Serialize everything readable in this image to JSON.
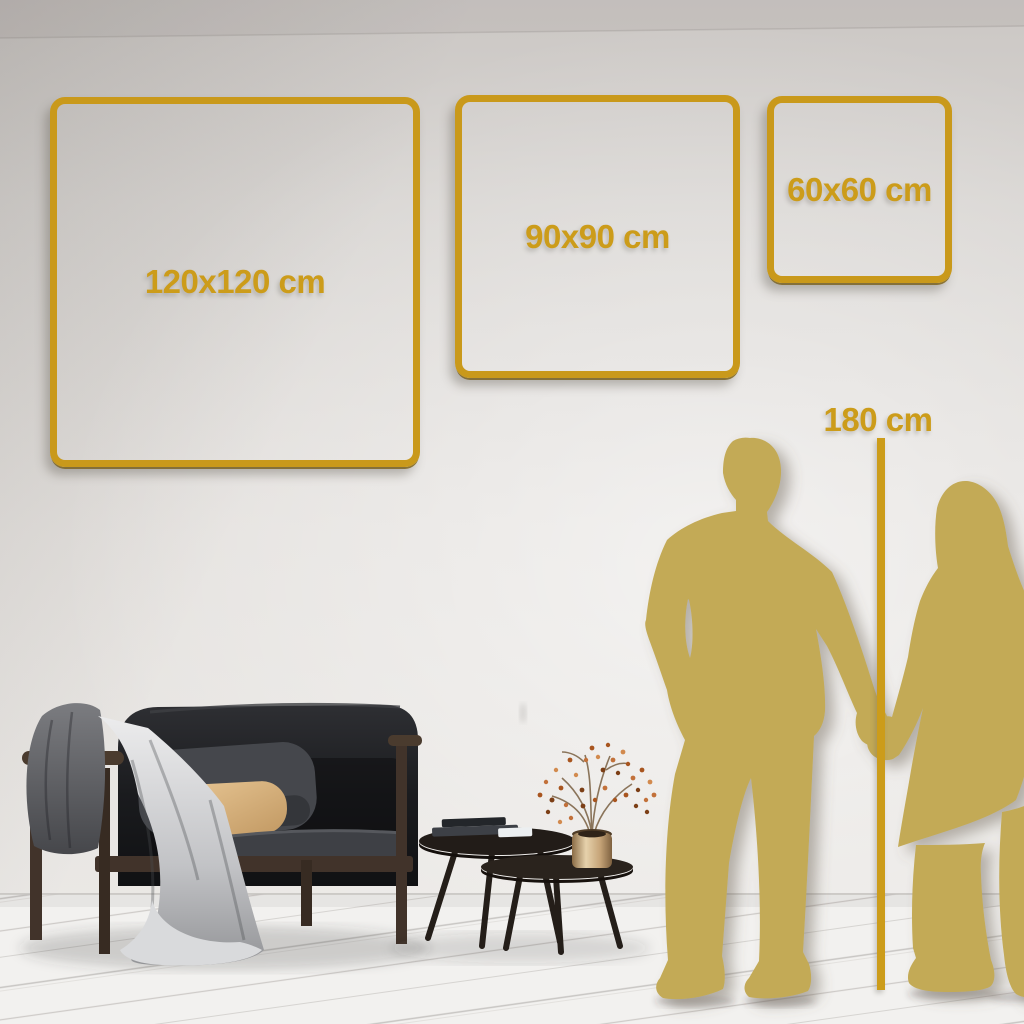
{
  "size_frames": [
    {
      "label": "120x120 cm"
    },
    {
      "label": "90x90 cm"
    },
    {
      "label": "60x60 cm"
    }
  ],
  "height_marker": {
    "label": "180 cm"
  },
  "accent_colors": {
    "gold": "#cc9c1a",
    "gold_frame": "#c9991b",
    "silhouette_gold": "#c3aa56"
  }
}
